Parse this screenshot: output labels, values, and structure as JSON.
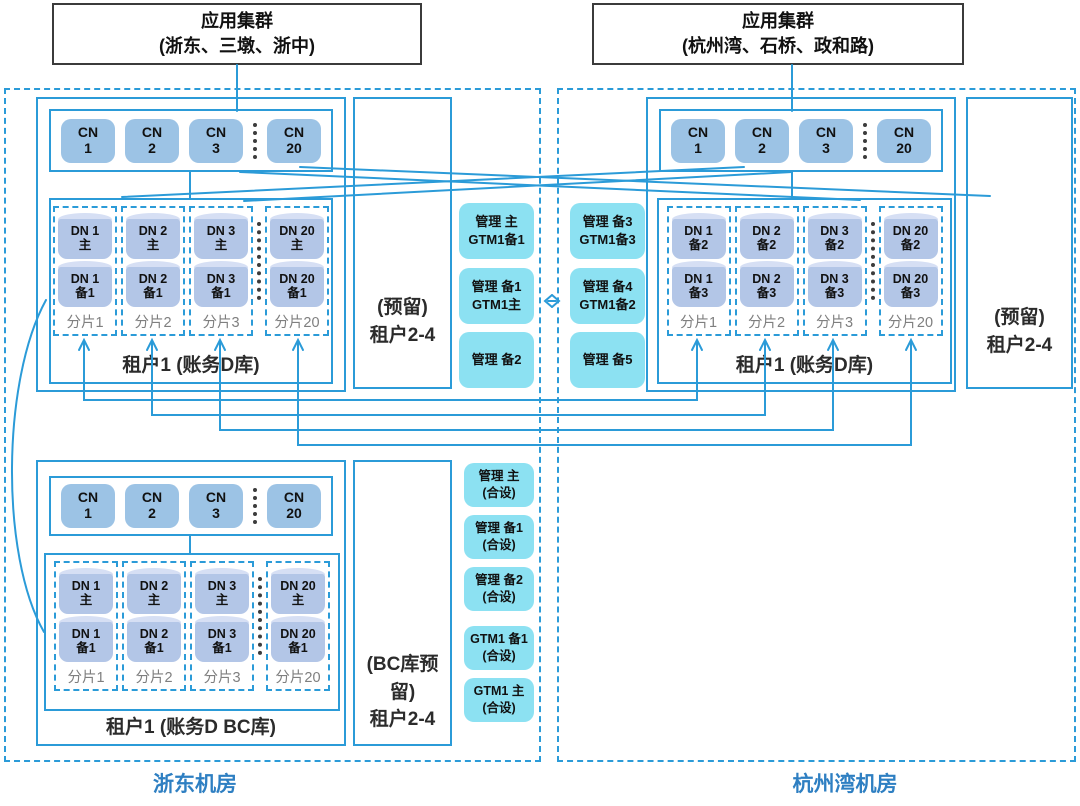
{
  "app_clusters": [
    {
      "line1": "应用集群",
      "line2": "(浙东、三墩、浙中)"
    },
    {
      "line1": "应用集群",
      "line2": "(杭州湾、石桥、政和路)"
    }
  ],
  "dc_labels": [
    "浙东机房",
    "杭州湾机房"
  ],
  "cn_nodes": [
    [
      "CN",
      "1"
    ],
    [
      "CN",
      "2"
    ],
    [
      "CN",
      "3"
    ],
    [
      "CN",
      "20"
    ]
  ],
  "clusters": {
    "upper_left": {
      "tenant": "租户1 (账务D库)",
      "shards": [
        {
          "top1": "DN 1",
          "top2": "主",
          "bot1": "DN 1",
          "bot2": "备1",
          "label": "分片1"
        },
        {
          "top1": "DN 2",
          "top2": "主",
          "bot1": "DN 2",
          "bot2": "备1",
          "label": "分片2"
        },
        {
          "top1": "DN 3",
          "top2": "主",
          "bot1": "DN 3",
          "bot2": "备1",
          "label": "分片3"
        },
        {
          "top1": "DN 20",
          "top2": "主",
          "bot1": "DN 20",
          "bot2": "备1",
          "label": "分片20"
        }
      ]
    },
    "upper_right": {
      "tenant": "租户1 (账务D库)",
      "shards": [
        {
          "top1": "DN 1",
          "top2": "备2",
          "bot1": "DN 1",
          "bot2": "备3",
          "label": "分片1"
        },
        {
          "top1": "DN 2",
          "top2": "备2",
          "bot1": "DN 2",
          "bot2": "备3",
          "label": "分片2"
        },
        {
          "top1": "DN 3",
          "top2": "备2",
          "bot1": "DN 3",
          "bot2": "备3",
          "label": "分片3"
        },
        {
          "top1": "DN 20",
          "top2": "备2",
          "bot1": "DN 20",
          "bot2": "备3",
          "label": "分片20"
        }
      ]
    },
    "lower_left": {
      "tenant": "租户1 (账务D BC库)",
      "shards": [
        {
          "top1": "DN 1",
          "top2": "主",
          "bot1": "DN 1",
          "bot2": "备1",
          "label": "分片1"
        },
        {
          "top1": "DN 2",
          "top2": "主",
          "bot1": "DN 2",
          "bot2": "备1",
          "label": "分片2"
        },
        {
          "top1": "DN 3",
          "top2": "主",
          "bot1": "DN 3",
          "bot2": "备1",
          "label": "分片3"
        },
        {
          "top1": "DN 20",
          "top2": "主",
          "bot1": "DN 20",
          "bot2": "备1",
          "label": "分片20"
        }
      ]
    }
  },
  "reserved": {
    "upper_left": [
      "(预留)",
      "租户2-4"
    ],
    "upper_right": [
      "(预留)",
      "租户2-4"
    ],
    "lower_left": [
      "(BC库预留)",
      "租户2-4"
    ]
  },
  "mgmt": {
    "upper_left": [
      [
        "管理 主",
        "GTM1备1"
      ],
      [
        "管理 备1",
        "GTM1主"
      ],
      [
        "管理 备2"
      ]
    ],
    "upper_right": [
      [
        "管理 备3",
        "GTM1备3"
      ],
      [
        "管理 备4",
        "GTM1备2"
      ],
      [
        "管理 备5"
      ]
    ],
    "lower": [
      [
        "管理 主",
        "(合设)"
      ],
      [
        "管理 备1",
        "(合设)"
      ],
      [
        "管理 备2",
        "(合设)"
      ],
      [
        "GTM1 备1",
        "(合设)"
      ],
      [
        "GTM1 主",
        "(合设)"
      ]
    ]
  },
  "colors": {
    "line_blue": "#2b9bd8",
    "cn_fill": "#9cc3e5",
    "dn_fill": "#b3c6e7",
    "dn_top": "#d6dff4",
    "mgmt_fill": "#8ce1f2",
    "shard_label_gray": "#7f7f7f",
    "dc_label_blue": "#2e7fc2"
  }
}
